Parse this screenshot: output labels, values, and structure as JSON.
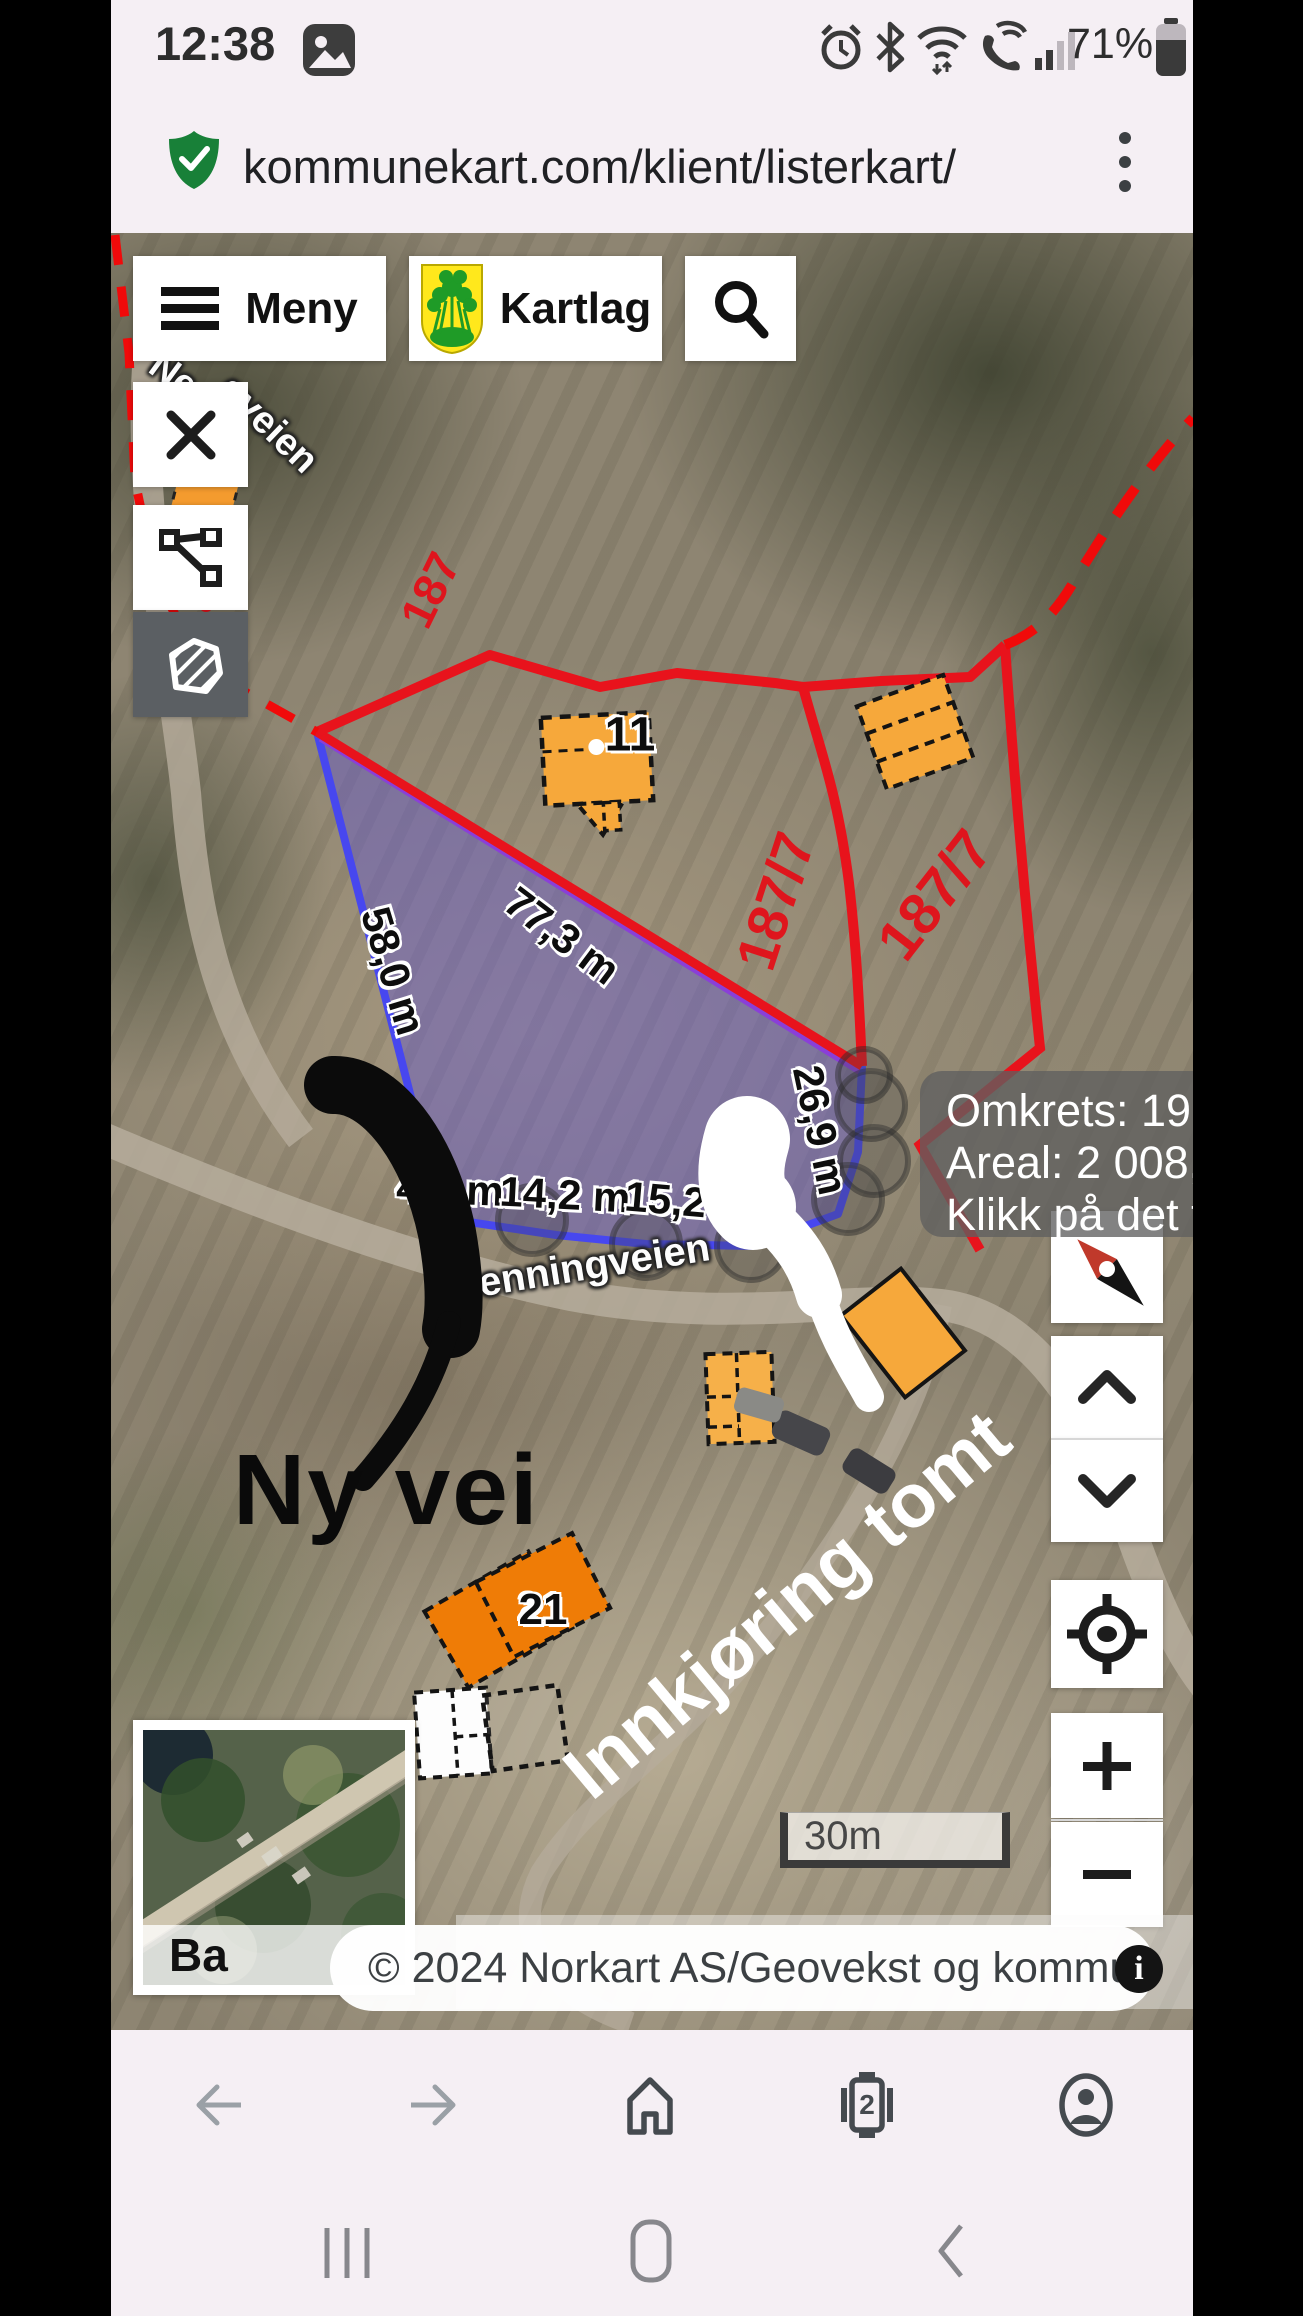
{
  "status_bar": {
    "time": "12:38",
    "battery": "71%"
  },
  "browser": {
    "url": "kommunekart.com/klient/listerkart/",
    "tab_count": "2"
  },
  "toolbar": {
    "meny": "Meny",
    "kartlag": "Kartlag"
  },
  "measure_panel": {
    "perimeter": "Omkrets: 199,9 m",
    "area": "Areal: 2 008,6 m²",
    "hint": "Klikk på det først"
  },
  "measurements": {
    "left_edge": "58,0 m",
    "top_edge": "77,3 m",
    "bottom_1": "4,7 m",
    "bottom_2": "14,2 m",
    "bottom_3": "15,2 m",
    "right_edge": "26,9 m"
  },
  "parcels": {
    "p1": "187/7",
    "p2": "187/7",
    "p3": "187"
  },
  "buildings": {
    "house_11": "11",
    "house_21": "21"
  },
  "roads": {
    "main": "Nenningveien",
    "fragment_upper": "Ne",
    "fragment_lower": "gveien"
  },
  "annotations": {
    "black_arrow_text": "Ny vei",
    "white_arrow_text": "Innkjøring tomt"
  },
  "scale_bar": {
    "label": "30m"
  },
  "attribution": {
    "text": "© 2024 Norkart AS/Geovekst og kommunene/NASA, Meti",
    "minimap_label": "Ba",
    "info_glyph": "i"
  },
  "colors": {
    "boundary_red": "#e8131c",
    "polygon_fill": "#685cc4",
    "polygon_edge_blue": "#4747ef",
    "measure_purple": "#8a3fd8",
    "building_orange": "#f6a83b",
    "building_orange_dark": "#ef7c06",
    "shield_green": "#188038",
    "selected_tool_bg": "#5b5f63"
  },
  "icons": [
    "gallery-icon",
    "alarm-icon",
    "bluetooth-icon",
    "wifi-icon",
    "wifi-call-icon",
    "signal-icon",
    "battery-icon",
    "shield-check-icon",
    "overflow-menu-icon",
    "menu-icon",
    "municipality-crest-icon",
    "search-icon",
    "close-icon",
    "measure-line-icon",
    "measure-area-icon",
    "compass-icon",
    "chevron-up-icon",
    "chevron-down-icon",
    "locate-icon",
    "zoom-in-icon",
    "zoom-out-icon",
    "info-icon",
    "back-icon",
    "forward-icon",
    "home-icon",
    "tabs-icon",
    "profile-icon",
    "recents-icon",
    "android-home-icon",
    "android-back-icon"
  ]
}
